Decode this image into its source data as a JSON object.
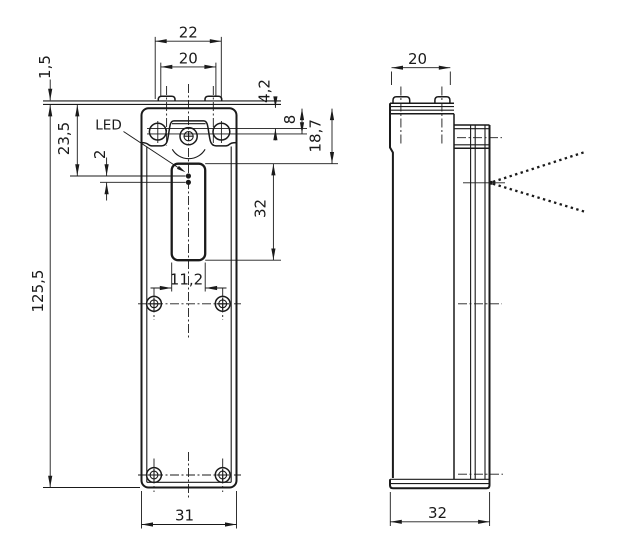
{
  "drawing": {
    "type": "technical-dimension-drawing",
    "views": {
      "front": {
        "led_label": "LED",
        "dims": {
          "tab_width_outer": "22",
          "tab_width_inner": "20",
          "plate_thickness": "1,5",
          "led_from_top": "23,5",
          "led_dot_spacing": "2",
          "head_step": "4,2",
          "hole_axis_from_top": "8",
          "window_from_top": "18,7",
          "window_height": "32",
          "overall_height": "125,5",
          "window_width": "11,2",
          "body_width": "31"
        }
      },
      "side": {
        "dims": {
          "top_width": "20",
          "depth": "32"
        }
      }
    },
    "colors": {
      "line": "#1a1a1a",
      "background": "#ffffff"
    }
  }
}
